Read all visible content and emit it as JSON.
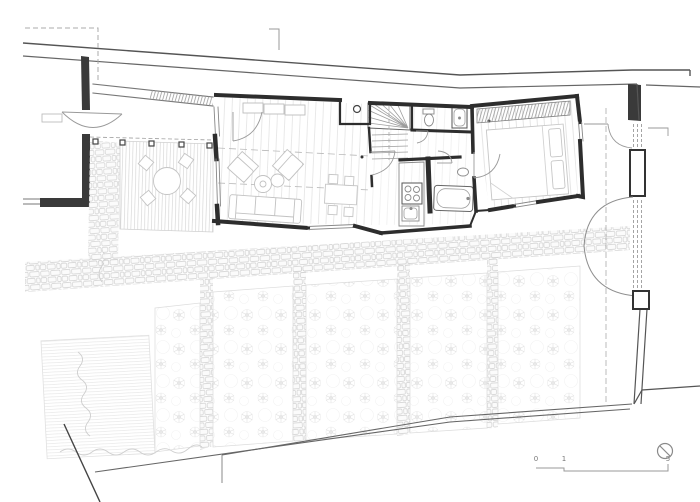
{
  "plan": {
    "scale_bar": {
      "labels": [
        "0",
        "1",
        "5"
      ]
    },
    "north_indicator": {
      "icon": "circle-with-diagonal-slash"
    },
    "ink_colors": {
      "walls": "#2d2d2d",
      "boundary": "#555555",
      "fixtures": "#8a8a8a",
      "furniture": "#c2c2c2",
      "vegetation": "#e0e0e0",
      "background": "#ffffff"
    }
  }
}
